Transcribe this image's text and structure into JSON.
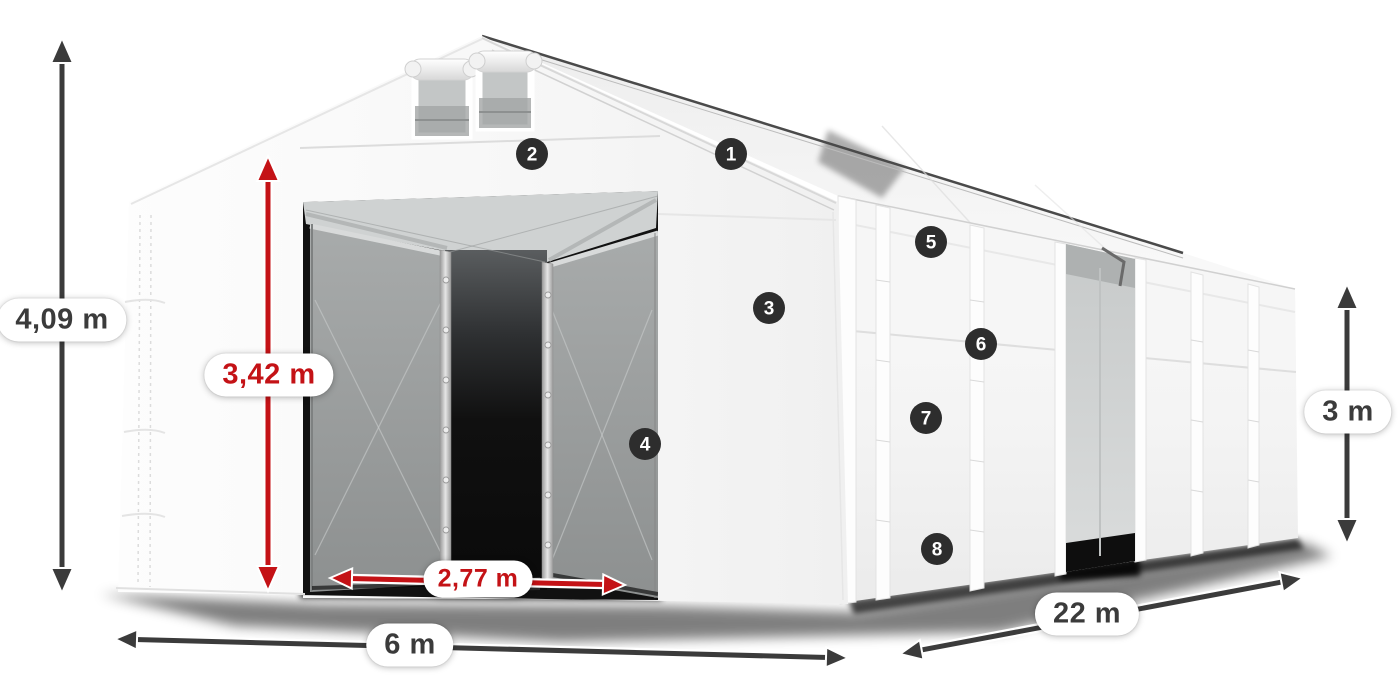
{
  "diagram": {
    "description": "White storage tent with dimension arrows and numbered feature markers"
  },
  "labels": {
    "total_height": "4,09 m",
    "entrance_height": "3,42 m",
    "entrance_width": "2,77 m",
    "width": "6 m",
    "length": "22 m",
    "side_height": "3 m"
  },
  "badges": [
    "1",
    "2",
    "3",
    "4",
    "5",
    "6",
    "7",
    "8"
  ],
  "colors": {
    "measure_dark": "#3b3b3b",
    "measure_red": "#c41216",
    "badge_bg": "#2d2d2d",
    "badge_text": "#ffffff",
    "pill_bg": "#ffffff"
  }
}
